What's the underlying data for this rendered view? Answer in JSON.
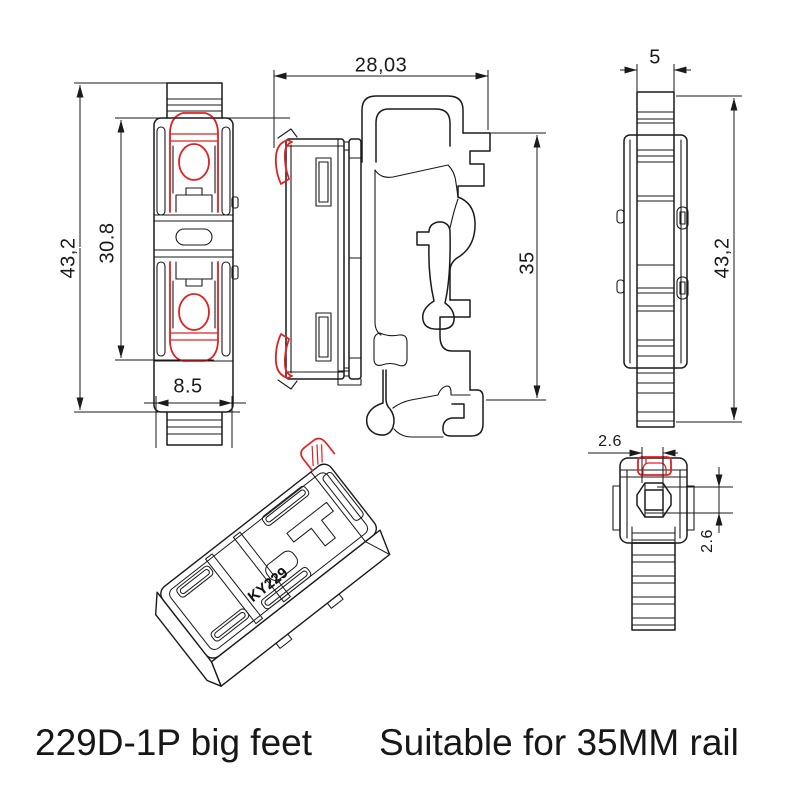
{
  "product": {
    "model": "229D-1P",
    "marking": "KY229"
  },
  "colors": {
    "line": "#1a1a1a",
    "highlight_red": "#e22020",
    "background": "#ffffff"
  },
  "views": {
    "front": {
      "title": "front view",
      "dims": {
        "overall_height": "43,2",
        "body_height": "30.8",
        "width": "8.5"
      }
    },
    "side": {
      "title": "side view on DIN rail",
      "dims": {
        "overall_width": "28,03",
        "rail_height": "35"
      }
    },
    "edge": {
      "title": "edge view",
      "dims": {
        "thickness": "5",
        "overall_height": "43,2"
      }
    },
    "top": {
      "title": "top view",
      "dims": {
        "clip_width": "2.6",
        "clip_depth": "2.6"
      }
    },
    "perspective": {
      "title": "3d perspective view",
      "marking": "KY229"
    }
  },
  "captions": {
    "left": "229D-1P big feet",
    "right": "Suitable for 35MM rail"
  }
}
